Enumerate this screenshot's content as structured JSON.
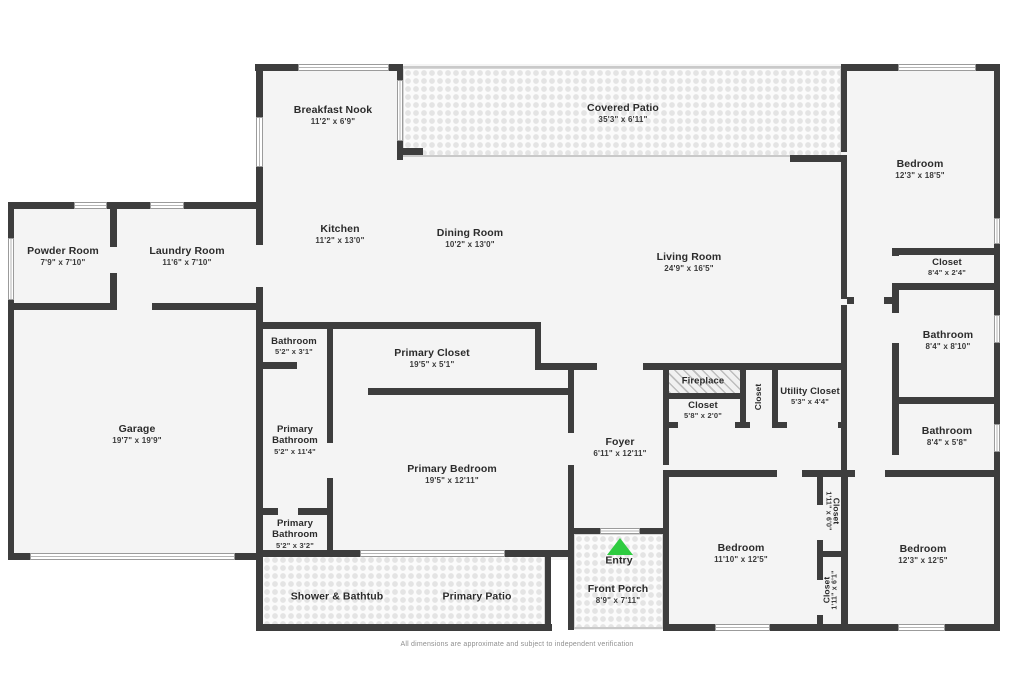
{
  "colors": {
    "wall": "#3d3d3d",
    "floor_fill": "#f4f4f4",
    "entry_arrow_green": "#2ecc40"
  },
  "entry_marker": "triangle-up-icon",
  "rooms": {
    "breakfast_nook": {
      "name": "Breakfast Nook",
      "dims": "11'2\" x 6'9\""
    },
    "covered_patio": {
      "name": "Covered Patio",
      "dims": "35'3\" x 6'11\""
    },
    "kitchen": {
      "name": "Kitchen",
      "dims": "11'2\" x 13'0\""
    },
    "dining_room": {
      "name": "Dining Room",
      "dims": "10'2\" x 13'0\""
    },
    "living_room": {
      "name": "Living Room",
      "dims": "24'9\" x 16'5\""
    },
    "bedroom_top_right": {
      "name": "Bedroom",
      "dims": "12'3\" x 18'5\""
    },
    "powder_room": {
      "name": "Powder Room",
      "dims": "7'9\" x 7'10\""
    },
    "laundry_room": {
      "name": "Laundry Room",
      "dims": "11'6\" x 7'10\""
    },
    "garage": {
      "name": "Garage",
      "dims": "19'7\" x 19'9\""
    },
    "closet_hall": {
      "name": "Closet",
      "dims": "8'4\" x 2'4\""
    },
    "bathroom_hall": {
      "name": "Bathroom",
      "dims": "8'4\" x 8'10\""
    },
    "bathroom_right": {
      "name": "Bathroom",
      "dims": "8'4\" x 5'8\""
    },
    "bathroom_small": {
      "name": "Bathroom",
      "dims": "5'2\" x 3'1\""
    },
    "primary_closet": {
      "name": "Primary Closet",
      "dims": "19'5\" x 5'1\""
    },
    "primary_bathroom_large": {
      "name": "Primary Bathroom",
      "dims": "5'2\" x 11'4\""
    },
    "primary_bathroom_small": {
      "name": "Primary Bathroom",
      "dims": "5'2\" x 3'2\""
    },
    "primary_bedroom": {
      "name": "Primary Bedroom",
      "dims": "19'5\" x 12'11\""
    },
    "fireplace": {
      "name": "Fireplace"
    },
    "closet_foyer": {
      "name": "Closet",
      "dims": "5'8\" x 2'0\""
    },
    "closet_mid": {
      "name": "Closet"
    },
    "utility_closet": {
      "name": "Utility Closet",
      "dims": "5'3\" x 4'4\""
    },
    "foyer": {
      "name": "Foyer",
      "dims": "6'11\" x 12'11\""
    },
    "entry": {
      "name": "Entry"
    },
    "front_porch": {
      "name": "Front Porch",
      "dims": "8'9\" x 7'11\""
    },
    "shower_bathtub": {
      "name": "Shower & Bathtub"
    },
    "primary_patio": {
      "name": "Primary Patio"
    },
    "bedroom_bottom_left": {
      "name": "Bedroom",
      "dims": "11'10\" x 12'5\""
    },
    "bedroom_bottom_right": {
      "name": "Bedroom",
      "dims": "12'3\" x 12'5\""
    },
    "closet_vertical_top": {
      "name": "Closet",
      "dims": "1'11\" x 6'0\""
    },
    "closet_vertical_bottom": {
      "name": "Closet",
      "dims": "1'11\" x 6'1\""
    }
  },
  "footer": {
    "disclaimer": "All dimensions are approximate and subject to independent verification"
  }
}
